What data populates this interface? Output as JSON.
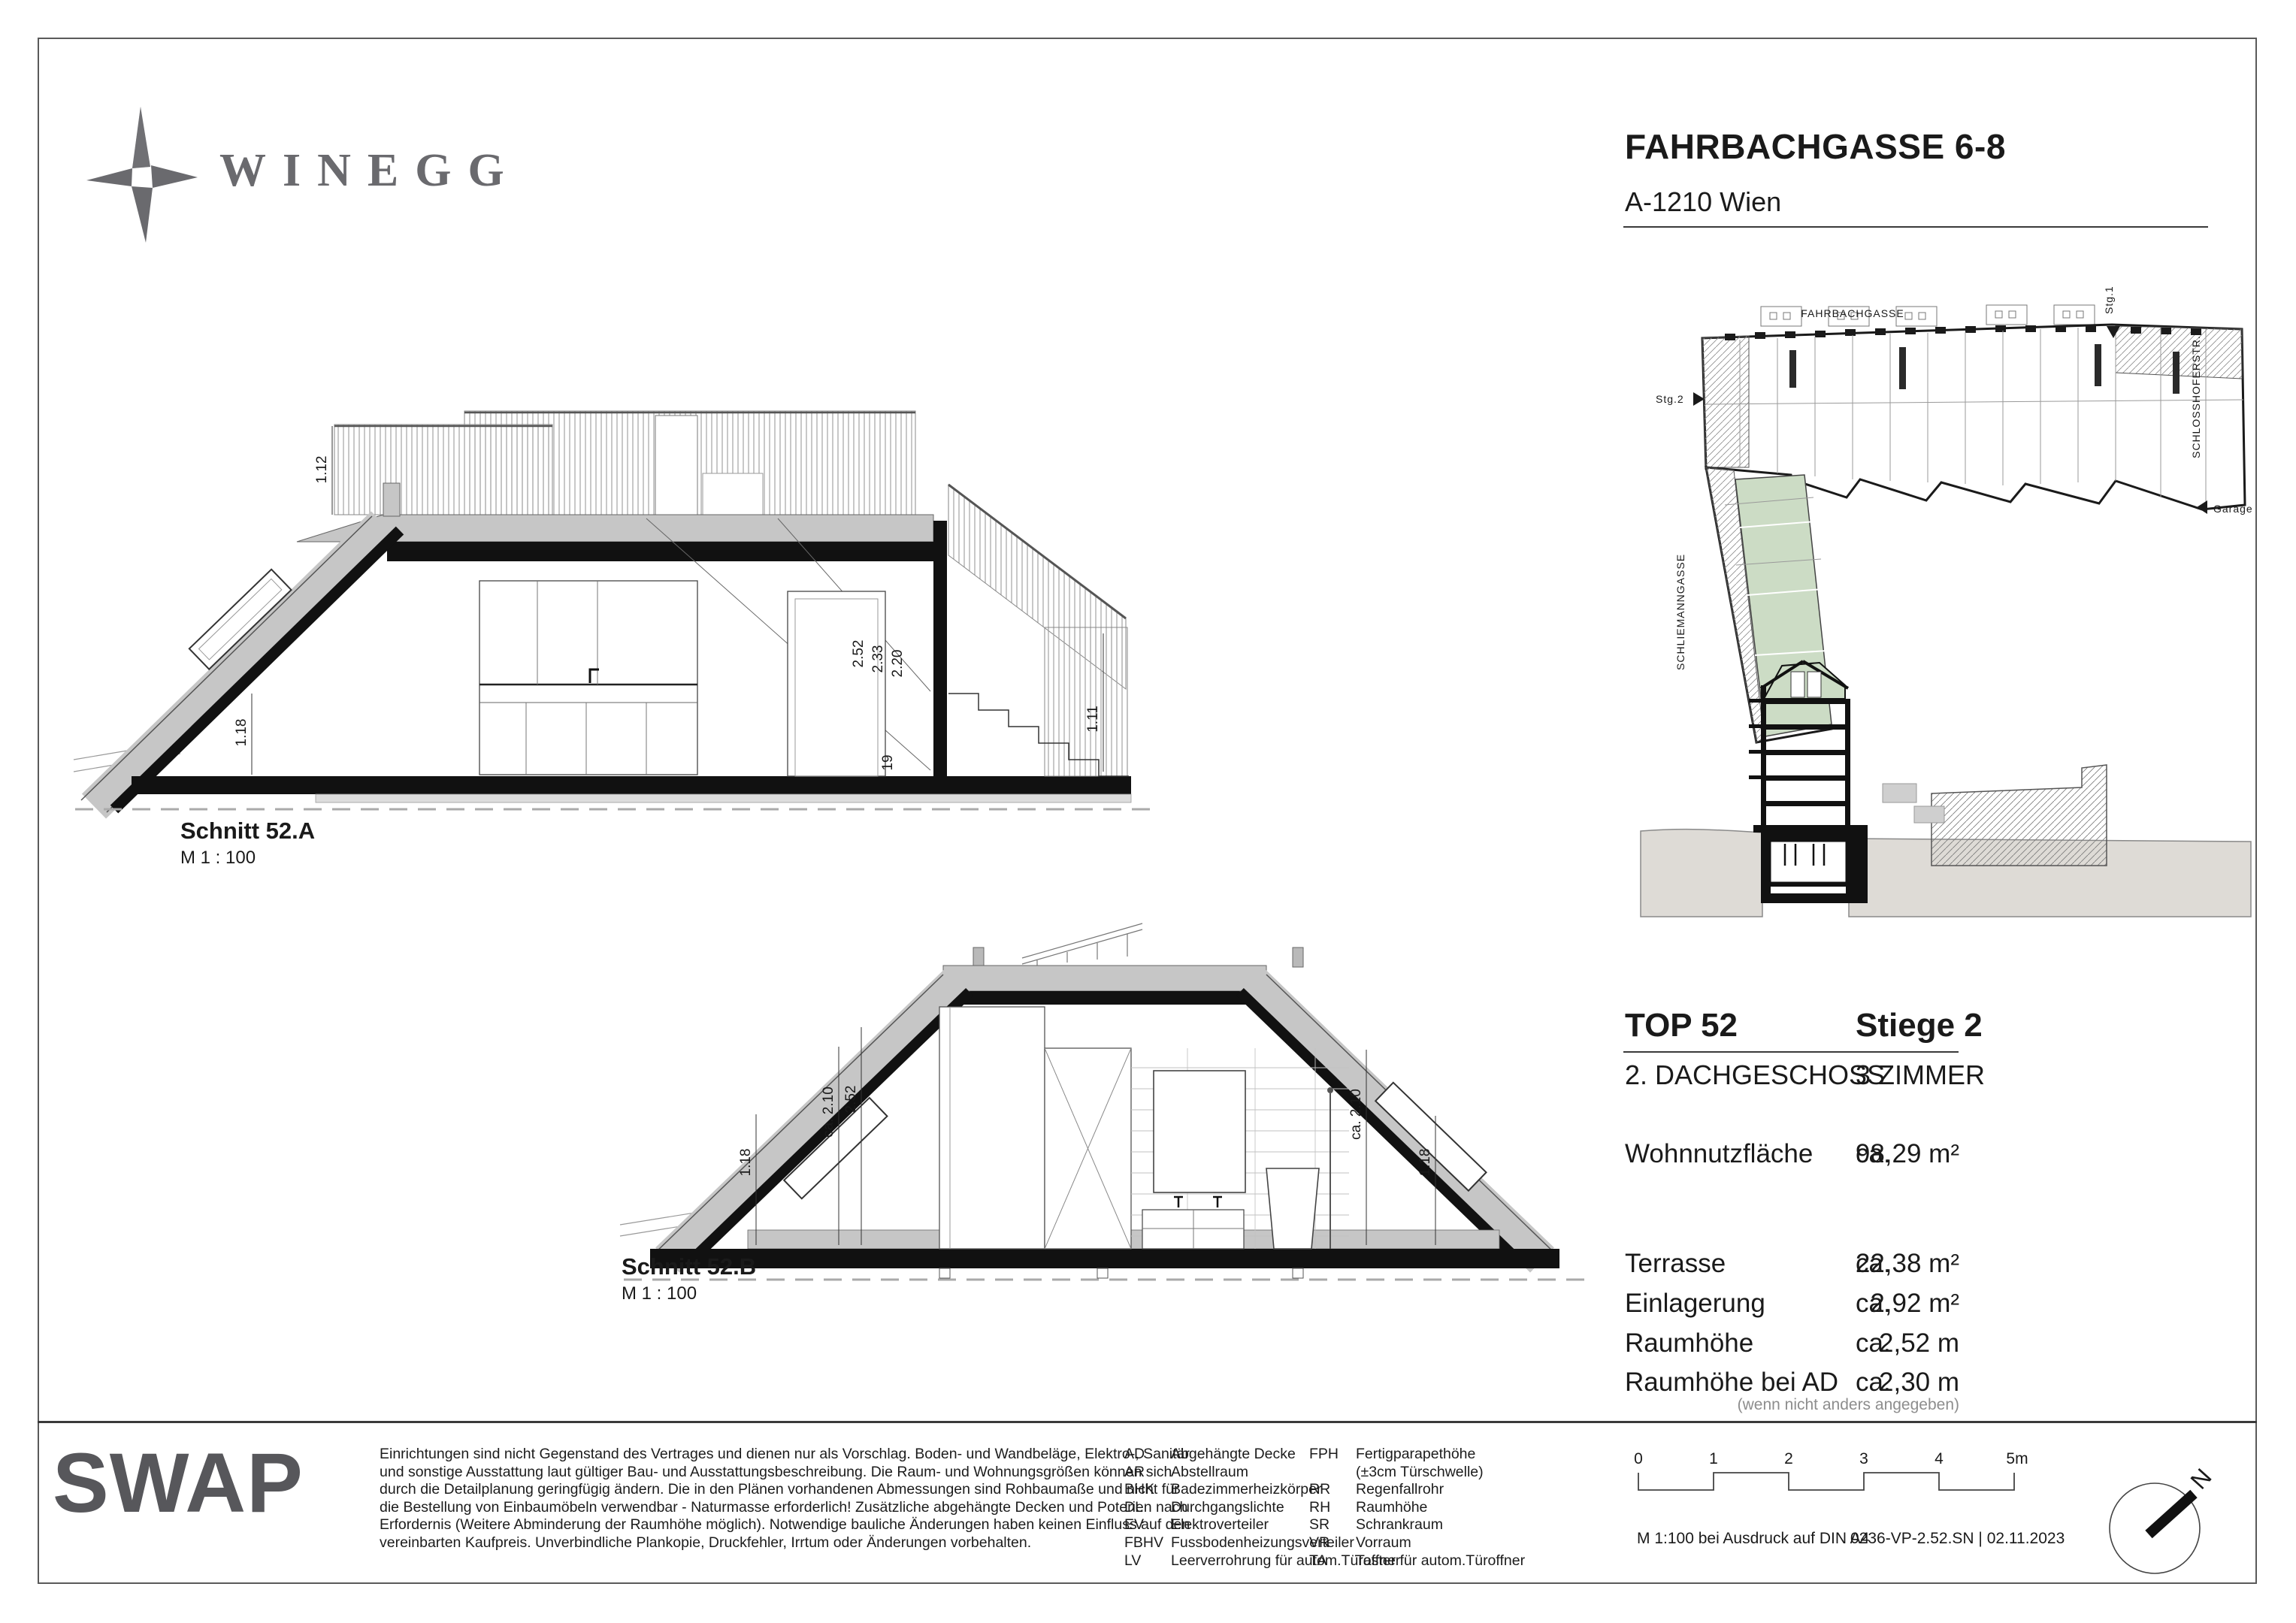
{
  "header": {
    "brand": "WINEGG",
    "project": "FAHRBACHGASSE 6-8",
    "city": "A-1210 Wien"
  },
  "siteplan": {
    "street_top": "FAHRBACHGASSE",
    "street_right": "SCHLOSSHOFERSTR.",
    "street_left": "SCHLIEMANNGASSE",
    "stair1": "Stg.1",
    "stair2": "Stg.2",
    "garage": "Garage"
  },
  "sections": {
    "a": {
      "title": "Schnitt 52.A",
      "scale": "M  1 : 100",
      "dims": {
        "terrace_railing": "1.12",
        "knee": "1.18",
        "room_h1": "2.52",
        "room_h2": "2.33",
        "room_h3": "2.20",
        "step": "19",
        "stair_railing": "1.11"
      }
    },
    "b": {
      "title": "Schnitt 52.B",
      "scale": "M  1 : 100",
      "dims": {
        "knee_left": "1.18",
        "clear_left": "ca. 2.10",
        "room_left": "2.52",
        "clear_right": "ca. 2.10",
        "knee_right": "1.18"
      }
    }
  },
  "unit": {
    "top_label": "TOP 52",
    "stair_label": "Stiege 2",
    "floor_label": "2. DACHGESCHOSS",
    "rooms_label": "3 ZIMMER",
    "area": {
      "label": "Wohnnutzfläche",
      "ca": "ca.",
      "value": "98,29 m²"
    },
    "details": [
      {
        "label": "Terrasse",
        "ca": "ca.",
        "value": "22,38 m²"
      },
      {
        "label": "Einlagerung",
        "ca": "ca.",
        "value": "2,92 m²"
      },
      {
        "label": "Raumhöhe",
        "ca": "ca.",
        "value": "2,52 m"
      },
      {
        "label": "Raumhöhe bei AD",
        "ca": "ca.",
        "value": "2,30 m"
      }
    ],
    "note": "(wenn nicht anders angegeben)"
  },
  "footer": {
    "logo": "SWAP",
    "disclaimer_lines": [
      "Einrichtungen sind nicht Gegenstand des Vertrages und dienen nur als Vorschlag. Boden- und Wandbeläge, Elektro-, Sanitär",
      "und sonstige Ausstattung laut gültiger Bau- und Ausstattungsbeschreibung. Die Raum- und Wohnungsgrößen können sich",
      "durch die Detailplanung geringfügig ändern. Die in den Plänen vorhandenen Abmessungen sind Rohbaumaße und nicht für",
      "die Bestellung von Einbaumöbeln verwendbar - Naturmasse erforderlich! Zusätzliche abgehängte Decken und Poterien nach",
      "Erfordernis (Weitere Abminderung der Raumhöhe möglich). Notwendige bauliche Änderungen haben keinen Einfluss auf den",
      "vereinbarten Kaufpreis. Unverbindliche Plankopie, Druckfehler, Irrtum oder Änderungen vorbehalten."
    ],
    "legend_col1": [
      {
        "abbr": "AD",
        "label": "Abgehängte Decke"
      },
      {
        "abbr": "AR",
        "label": "Abstellraum"
      },
      {
        "abbr": "BHK",
        "label": "Badezimmerheizkörper"
      },
      {
        "abbr": "DL",
        "label": "Durchgangslichte"
      },
      {
        "abbr": "EV",
        "label": "Elektroverteiler"
      },
      {
        "abbr": "FBHV",
        "label": "Fussbodenheizungsverteiler"
      },
      {
        "abbr": "LV",
        "label": "Leerverrohrung für autom.Türoffner"
      }
    ],
    "legend_col2": [
      {
        "abbr": "FPH",
        "label": "Fertigparapethöhe\n(±3cm Türschwelle)"
      },
      {
        "abbr": "RR",
        "label": "Regenfallrohr"
      },
      {
        "abbr": "RH",
        "label": "Raumhöhe"
      },
      {
        "abbr": "SR",
        "label": "Schrankraum"
      },
      {
        "abbr": "VR",
        "label": "Vorraum"
      },
      {
        "abbr": "TA",
        "label": "Taster für autom.Türoffner"
      }
    ],
    "scale_ticks": [
      "0",
      "1",
      "2",
      "3",
      "4",
      "5m"
    ],
    "print_scale": "M 1:100 bei Ausdruck auf DIN A4",
    "doc_ref": "0236-VP-2.52.SN | 02.11.2023",
    "compass_n": "N"
  },
  "colors": {
    "highlight_green": "#ccdcc5",
    "roof_gray": "#c6c6c6",
    "ground_gray": "#dedbd6",
    "logo_gray": "#6a6a6e"
  }
}
